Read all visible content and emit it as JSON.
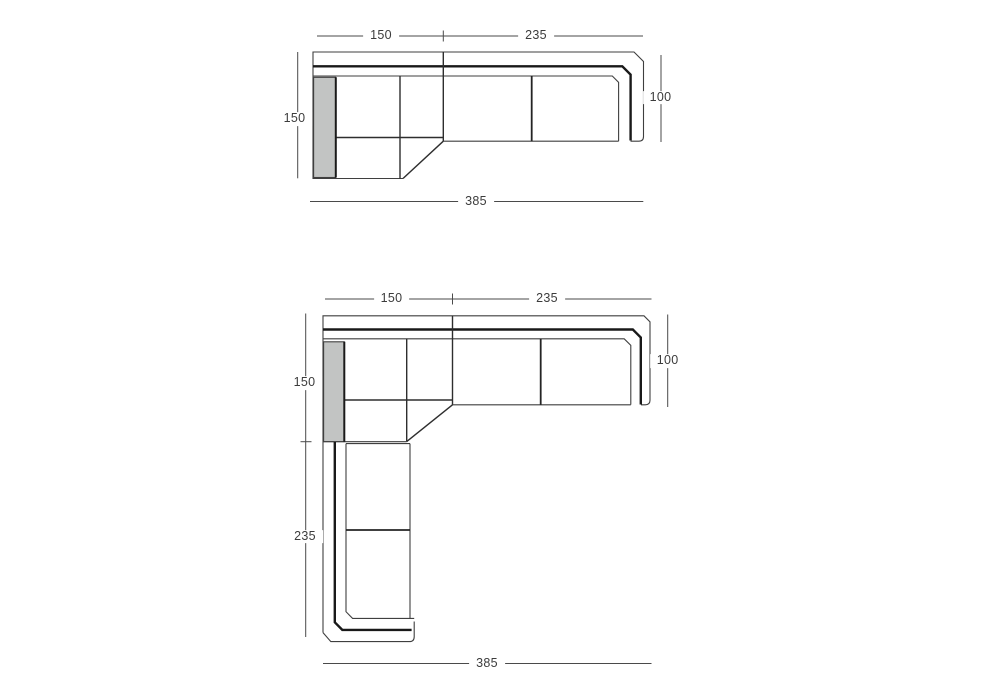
{
  "style": {
    "background": "#ffffff",
    "line_color": "#3f3f3f",
    "heavy_line_color": "#191919",
    "armrest_fill": "#c2c4c3",
    "text_color": "#3c3c3c"
  },
  "drawings": {
    "top_unit": {
      "dims": {
        "top_seg1": "150",
        "top_seg2": "235",
        "left": "150",
        "right": "100",
        "bottom": "385"
      }
    },
    "corner_unit": {
      "dims": {
        "top_seg1": "150",
        "top_seg2": "235",
        "left_upper": "150",
        "left_lower": "235",
        "right": "100",
        "bottom": "385"
      }
    }
  }
}
